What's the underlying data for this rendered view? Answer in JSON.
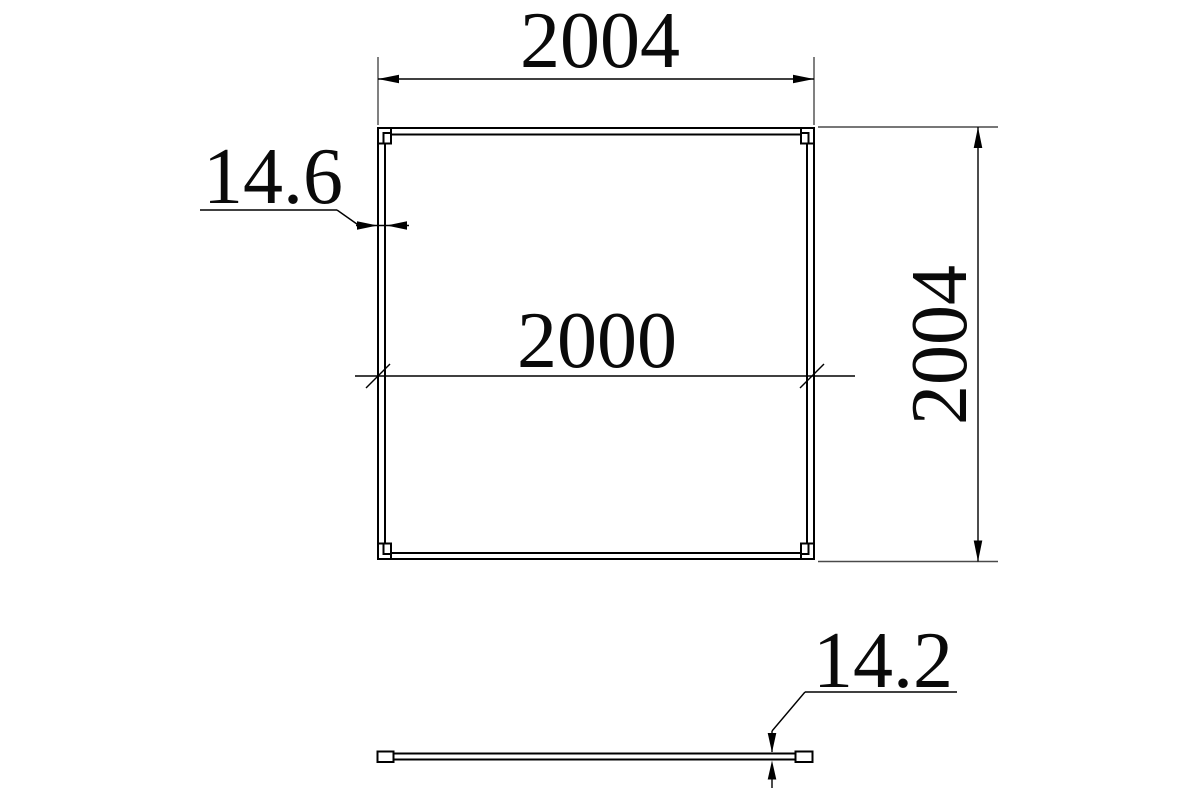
{
  "page": {
    "background_color": "#ffffff",
    "ink_color": "#000000",
    "extension_line_color": "#4a4a4a"
  },
  "drawing": {
    "front_view": {
      "overall_width_label": "2004",
      "overall_height_label": "2004",
      "inner_width_label": "2000",
      "profile_thickness_label": "14.6"
    },
    "side_view": {
      "panel_thickness_label": "14.2"
    }
  }
}
